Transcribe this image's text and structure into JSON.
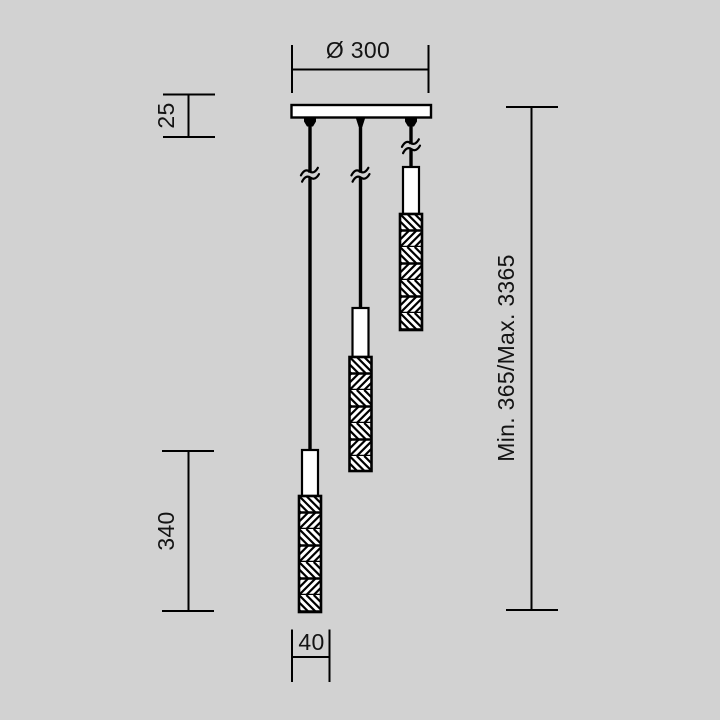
{
  "colors": {
    "background": "#d2d2d2",
    "line": "#000000",
    "surface": "#ffffff"
  },
  "labels": {
    "canopy_diameter": "Ø 300",
    "canopy_height": "25",
    "shade_length": "340",
    "shade_diameter": "40",
    "suspension_range": "Min. 365/Max. 3365"
  }
}
